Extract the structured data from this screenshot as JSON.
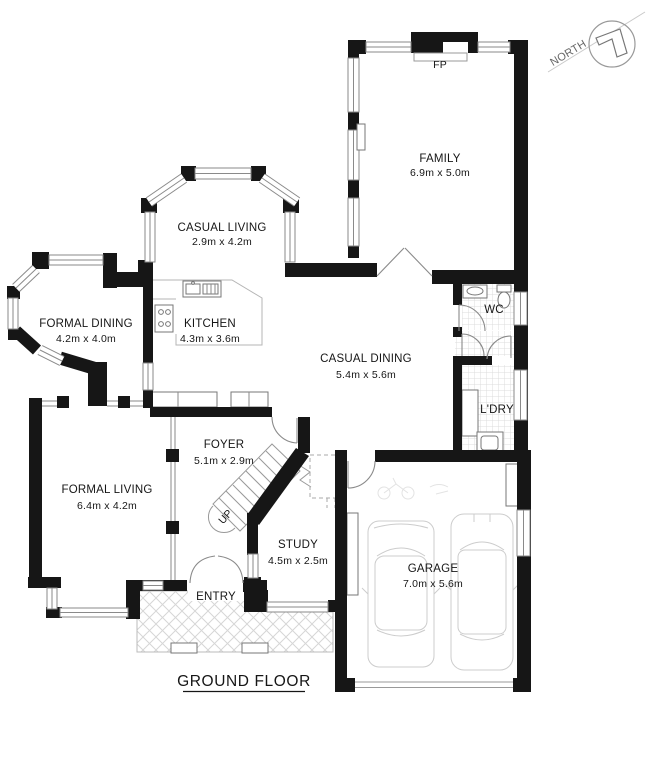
{
  "title": {
    "text": "GROUND FLOOR"
  },
  "compass": {
    "label": "NORTH"
  },
  "annotations": {
    "fireplace": "FP",
    "stairs_direction": "UP"
  },
  "rooms": {
    "family": {
      "name": "FAMILY",
      "dims": "6.9m x 5.0m"
    },
    "casual_living": {
      "name": "CASUAL LIVING",
      "dims": "2.9m x 4.2m"
    },
    "formal_dining": {
      "name": "FORMAL DINING",
      "dims": "4.2m x 4.0m"
    },
    "kitchen": {
      "name": "KITCHEN",
      "dims": "4.3m x 3.6m"
    },
    "casual_dining": {
      "name": "CASUAL DINING",
      "dims": "5.4m x 5.6m"
    },
    "wc": {
      "name": "WC"
    },
    "laundry": {
      "name": "L'DRY"
    },
    "foyer": {
      "name": "FOYER",
      "dims": "5.1m x 2.9m"
    },
    "formal_living": {
      "name": "FORMAL LIVING",
      "dims": "6.4m x 4.2m"
    },
    "study": {
      "name": "STUDY",
      "dims": "4.5m x 2.5m"
    },
    "entry": {
      "name": "ENTRY"
    },
    "garage": {
      "name": "GARAGE",
      "dims": "7.0m x 5.6m"
    }
  },
  "colors": {
    "wall": "#161616",
    "window_stroke": "#8a8a8a",
    "tile": "#dcdcdc"
  }
}
